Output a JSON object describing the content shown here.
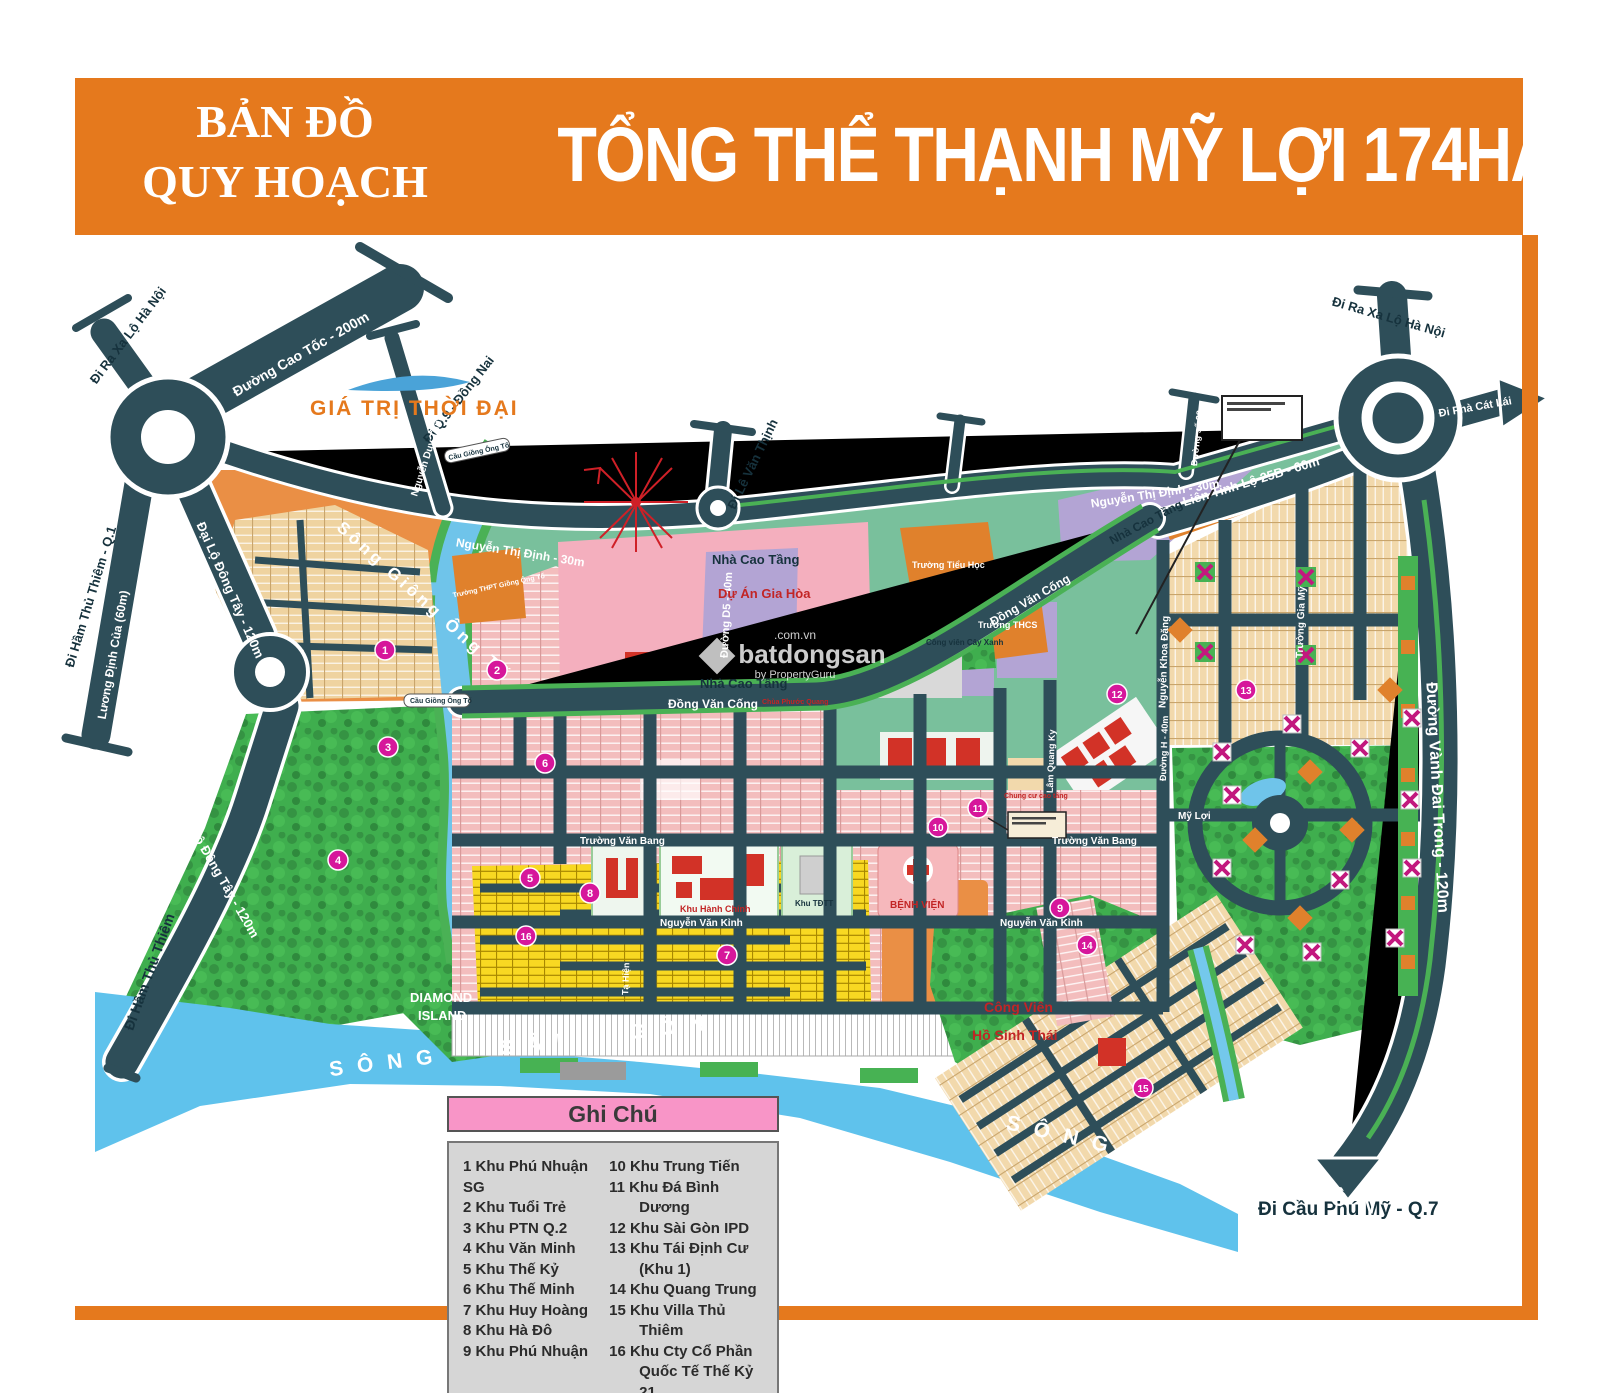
{
  "header": {
    "left_line1": "BẢN ĐỒ",
    "left_line2": "QUY HOẠCH",
    "main_title": "TỔNG THỂ THẠNH MỸ LỢI 174HA"
  },
  "branding": {
    "logo": "GIÁ TRỊ THỜI ĐẠI",
    "watermark_top": ".com.vn",
    "watermark_main": "batdongsan",
    "watermark_sub": "by PropertyGuru"
  },
  "water": {
    "song_sai_gon": "SÔNG SÀI GÒN",
    "song_giong_ong_to": "Sông Giồng Ông Tố",
    "diamond_line1": "DIAMOND",
    "diamond_line2": "ISLAND",
    "cau_giong_ong_to": "Cầu Giồng Ông Tố"
  },
  "roads": {
    "ntd": "Nguyễn Thị Định - 30m",
    "dvc": "Đồng Văn Cống",
    "dldt": "Đại Lộ Đông Tây - 120m",
    "ldc": "Lương Định Của (60m)",
    "dht_q1": "Đi Hầm Thủ Thiêm - Q.1",
    "dht": "Đi Hầm Thủ Thiêm",
    "cao_toc": "Đường Cao Tốc - 200m",
    "q9": "Đi Q.9 - Đồng Nai",
    "ra_xa_lo": "Đi Ra Xa Lộ Hà Nội",
    "le_van_thinh": "Đi Lê Văn Thịnh",
    "duy_trinh": "Nguyễn Duy Trinh",
    "d5": "Đường D5 - 40m",
    "so22": "Đường số 22",
    "ltl25b": "Liên Tỉnh Lộ 25B - 60m",
    "pha_cat_lai": "Đi Phà Cát Lái",
    "vanh_dai": "Đường Vành Đai Trong - 120m",
    "cau_phu_my": "Đi Cầu Phú Mỹ - Q.7",
    "truong_gia_my": "Trường Gia Mỹ",
    "nkd": "Nguyễn Khoa Đăng",
    "duong_h": "Đường H - 40m",
    "lqk": "Lâm Quang Ky",
    "tvb": "Trường Văn Bang",
    "nvk": "Nguyễn Văn Kỉnh",
    "my_loi": "Mỹ Lợi",
    "ta_hien": "Tạ Hiện"
  },
  "areas": {
    "du_an_gia_hoa": "Dự Án Gia Hòa",
    "nha_cao_tang": "Nhà Cao Tầng",
    "truong_tieu_hoc": "Trường Tiểu Học",
    "truong_thcs": "Trường THCS",
    "cong_vien_cay_xanh": "Công viên Cây Xanh",
    "thpt_got": "Trường THPT Giồng Ông Tố",
    "khu_hanh_chinh": "Khu Hành Chính",
    "khu_tdtt": "Khu TĐTT",
    "benh_vien": "BỆNH VIỆN",
    "cv_line1": "Công Viên",
    "cv_line2": "Hồ Sinh Thái",
    "chua": "Chùa Phước Quang",
    "chung_cu": "Chung cư cao tầng"
  },
  "markers": [
    "1",
    "2",
    "3",
    "4",
    "5",
    "6",
    "7",
    "8",
    "9",
    "10",
    "11",
    "12",
    "13",
    "14",
    "15",
    "16"
  ],
  "legend": {
    "title": "Ghi Chú",
    "left_items": [
      "1 Khu Phú Nhuận SG",
      "2 Khu Tuổi Trẻ",
      "3 Khu PTN Q.2",
      "4 Khu Văn Minh",
      "5 Khu Thế Kỷ",
      "6 Khu Thế Minh",
      "7 Khu Huy Hoàng",
      "8 Khu Hà Đô",
      "9 Khu Phú Nhuận"
    ],
    "right_items": [
      "10 Khu Trung Tiến",
      "11 Khu Đá Bình Dương",
      "12 Khu Sài Gòn IPD",
      "13 Khu Tái Định Cư (Khu 1)",
      "14 Khu Quang Trung",
      "15 Khu Villa Thủ Thiêm",
      "16 Khu Cty Cổ Phần Quốc Tế Thế Kỷ 21"
    ]
  }
}
